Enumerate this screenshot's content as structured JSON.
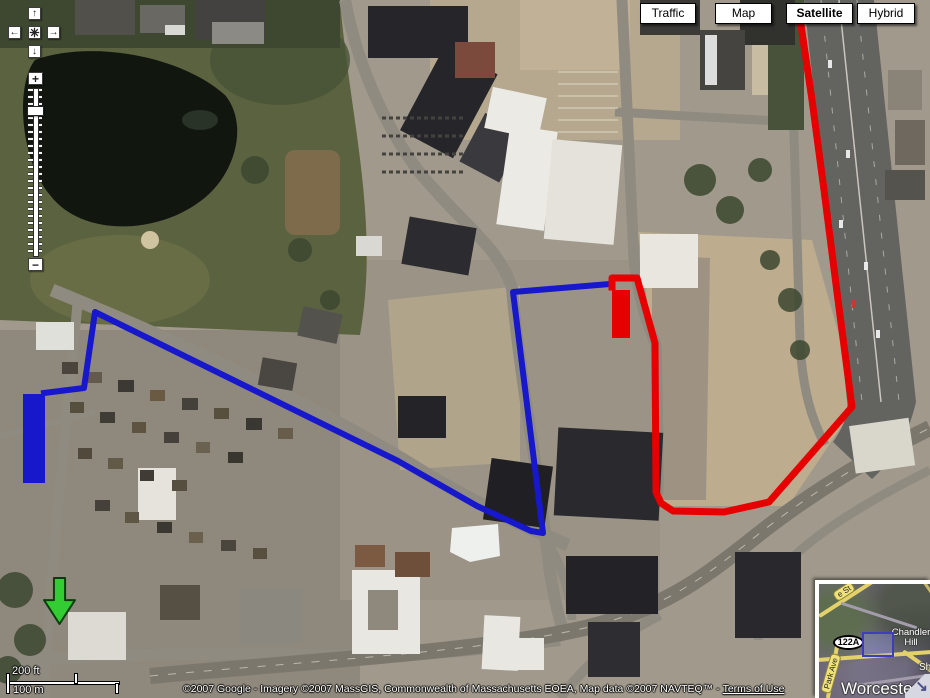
{
  "map_type_bar": {
    "buttons": [
      {
        "label": "Traffic",
        "selected": false
      },
      {
        "label": "Map",
        "selected": false
      },
      {
        "label": "Satellite",
        "selected": true
      },
      {
        "label": "Hybrid",
        "selected": false
      }
    ]
  },
  "navigation": {
    "pan_up_icon": "↑",
    "pan_left_icon": "←",
    "pan_right_icon": "→",
    "pan_down_icon": "↓",
    "center_icon": "return-to-last-result",
    "zoom_in_label": "+",
    "zoom_out_label": "−"
  },
  "scale_bar": {
    "feet_label": "200 ft",
    "meters_label": "100 m"
  },
  "attribution": {
    "text": "©2007 Google - Imagery ©2007 MassGIS, Commonwealth of Massachusetts EOEA, Map data ©2007 NAVTEQ™ -",
    "link_label": "Terms of Use"
  },
  "overview_map": {
    "city_label": "Worcester",
    "route_shield": "122A",
    "place_label_line1": "Chandler",
    "place_label_line2": "Hill",
    "street_label_top": "e St",
    "street_label_left": "Park Ave",
    "partial_label_right": "Sh",
    "collapse_arrow_icon": "↘"
  },
  "map_overlays": {
    "blue_route": {
      "color": "#1717cc",
      "width": 6,
      "points": [
        [
          44,
          393
        ],
        [
          84,
          388
        ],
        [
          95,
          312
        ],
        [
          398,
          461
        ],
        [
          477,
          506
        ],
        [
          531,
          531
        ],
        [
          543,
          533
        ],
        [
          513,
          292
        ],
        [
          610,
          284
        ]
      ]
    },
    "red_route": {
      "color": "#e60000",
      "width": 7,
      "points": [
        [
          612,
          287
        ],
        [
          612,
          278
        ],
        [
          637,
          278
        ],
        [
          655,
          343
        ],
        [
          656,
          492
        ],
        [
          661,
          503
        ],
        [
          673,
          511
        ],
        [
          724,
          512
        ],
        [
          769,
          502
        ],
        [
          852,
          407
        ],
        [
          838,
          300
        ],
        [
          824,
          190
        ],
        [
          812,
          100
        ],
        [
          801,
          25
        ]
      ]
    },
    "blue_area": {
      "color": "#1717cc",
      "x": 23,
      "y": 394,
      "width": 22,
      "height": 89
    },
    "red_area": {
      "color": "#e60000",
      "x": 612,
      "y": 290,
      "width": 18,
      "height": 48
    },
    "green_arrow": {
      "color": "#33cc33",
      "outline": "#0b3d0b",
      "x": 44,
      "y": 578,
      "width": 31,
      "height": 46
    }
  }
}
